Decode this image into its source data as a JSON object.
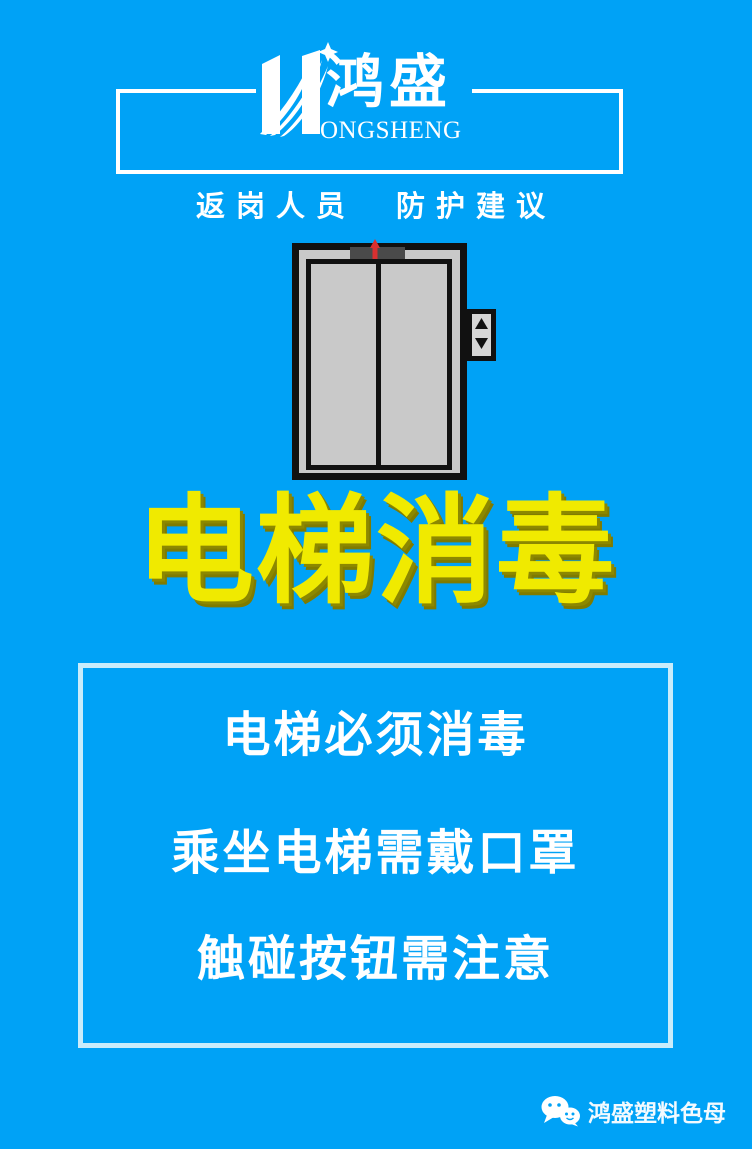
{
  "poster": {
    "kind": "epidemic-prevention-poster",
    "colors": {
      "background": "#00a2f6",
      "title_yellow": "#f0ea00",
      "title_shadow": "#7f7b00",
      "header_border": "#ffffff",
      "notice_border": "#c9ecfb",
      "elevator_gray": "#c9c9c9",
      "elevator_panel_dark": "#4a4a4a",
      "indicator_red": "#d83030",
      "text_white": "#ffffff"
    }
  },
  "header": {
    "logo": {
      "chinese": "鸿盛",
      "english": "ONGSHENG",
      "icon": "hongsheng-h-swoosh-star"
    },
    "subtitle": "返岗人员　防护建议"
  },
  "title": {
    "text": "电梯消毒"
  },
  "notice": {
    "lines": [
      "电梯必须消毒",
      "乘坐电梯需戴口罩",
      "触碰按钮需注意"
    ]
  },
  "watermark": {
    "icon": "wechat-icon",
    "text": "鸿盛塑料色母"
  }
}
